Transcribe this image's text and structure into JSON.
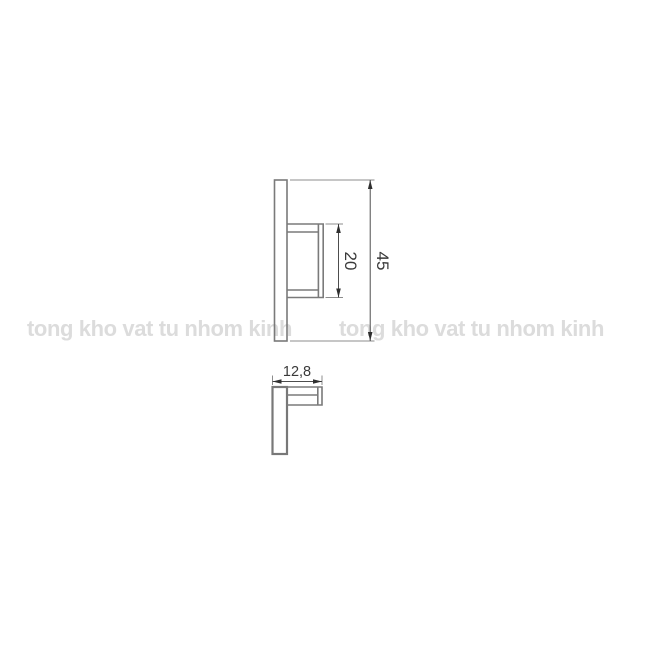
{
  "page": {
    "background_color": "#ffffff"
  },
  "watermark": {
    "text": "tong kho vat tu nhom kinh",
    "color": "#dcdcdc",
    "instances": [
      "tong kho vat tu nhom kinh",
      "tong kho vat tu nhom kinh"
    ]
  },
  "drawing": {
    "type": "technical-dimension-drawing",
    "line_color": "#7a7a7a",
    "dimension_line_color": "#4d4d4d",
    "dimension_text_color": "#3a3a3a",
    "dimensions": {
      "bracket_height": "20",
      "total_height": "45",
      "depth": "12,8"
    }
  }
}
